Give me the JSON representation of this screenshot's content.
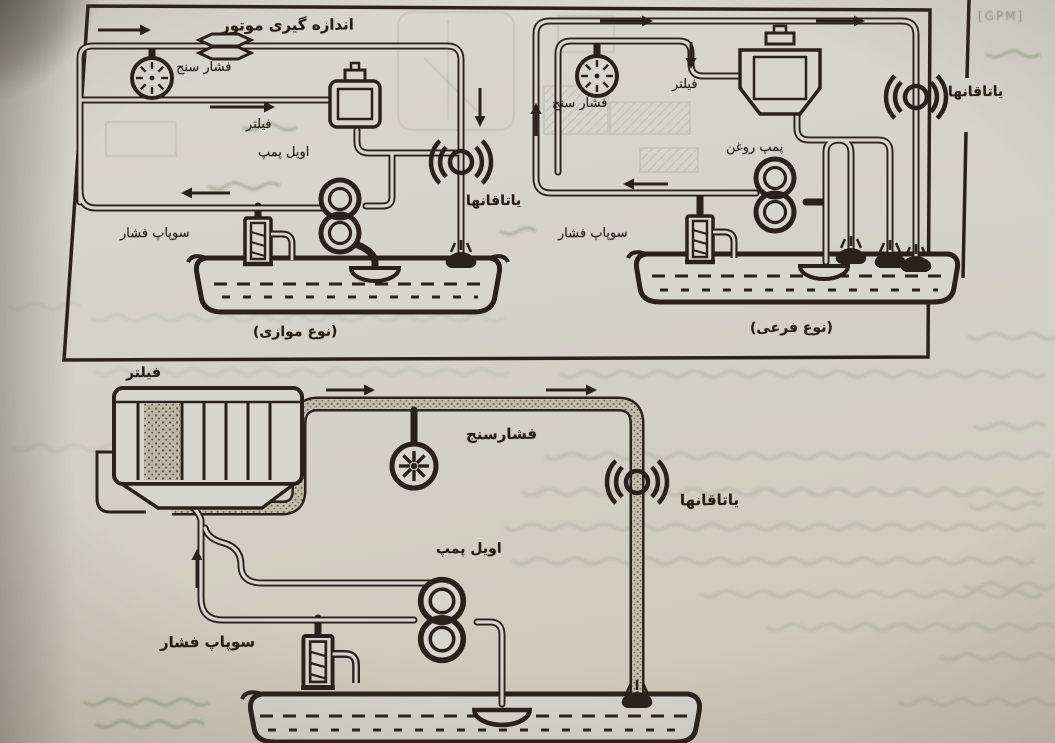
{
  "figures": {
    "parallel": {
      "title": "اندازه گیری موتور",
      "gauge": "فشار سنج",
      "filter": "فیلتر",
      "pump": "اویل پمپ",
      "valve": "سوپاپ فشار",
      "bearings": "یاتاقانها",
      "caption": "(نوع موازی)"
    },
    "bypass": {
      "gauge": "فشار سنج",
      "filter": "فیلتر",
      "pump": "پمپ روغن",
      "valve": "سوپاپ فشار",
      "bearings": "یاتاقانها",
      "caption": "(نوع فرعی)"
    },
    "single": {
      "filter": "فیلتر",
      "gauge": "فشارسنج",
      "bearings": "یاتاقانها",
      "pump": "اویل پمپ",
      "valve": "سوپاپ فشار"
    }
  },
  "margin": {
    "faint_print": "[GPM]"
  },
  "colors": {
    "ink": "#29221a",
    "paper": "#d5d2c9"
  }
}
